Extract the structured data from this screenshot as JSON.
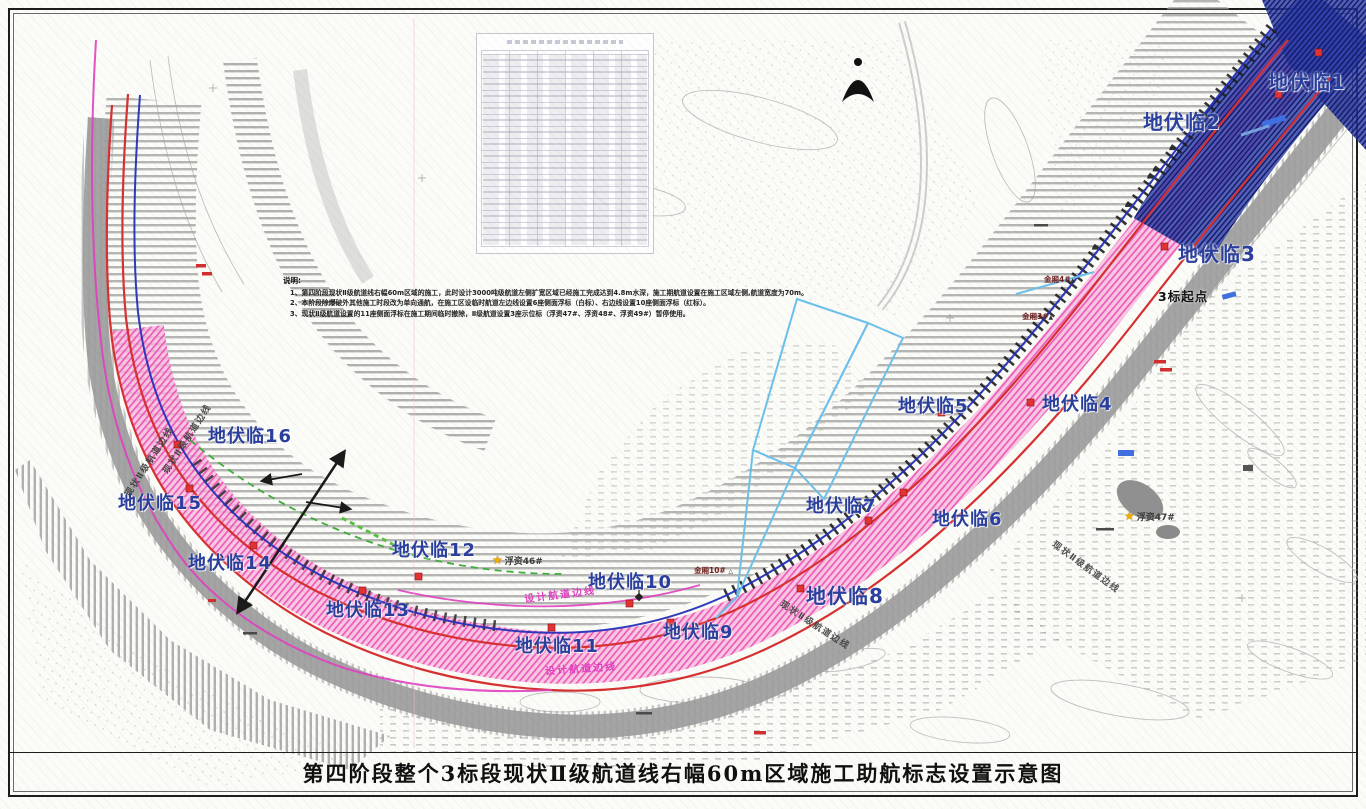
{
  "frame": {
    "title": "第四阶段整个3标段现状Ⅱ级航道线右幅60m区域施工助航标志设置示意图"
  },
  "notes": {
    "heading": "说明:",
    "items": [
      "1、第四阶段现状Ⅱ级航道线右幅60m区域的施工，此时设计3000吨级航道左侧扩宽区域已经施工完成达到4.8m水深，施工期航道设置在施工区域左侧,航道宽度为70m。",
      "2、本阶段除爆破外其他施工时段改为单向通航，在施工区设临时航道左边线设置6座侧面浮标（白标）、右边线设置10座侧面浮标（红标）。",
      "3、现状Ⅱ级航道设置的11座侧面浮标在施工期间临时撤除，Ⅱ级航道设置3座示位标（浮资47#、浮资48#、浮资49#）暂停使用。"
    ]
  },
  "temp_markers": {
    "labels": [
      "地伏临1",
      "地伏临2",
      "地伏临3",
      "地伏临4",
      "地伏临5",
      "地伏临6",
      "地伏临7",
      "地伏临8",
      "地伏临9",
      "地伏临10",
      "地伏临11",
      "地伏临12",
      "地伏临13",
      "地伏临14",
      "地伏临15",
      "地伏临16"
    ]
  },
  "stations": {
    "jinxiang_4": "金厢4#",
    "jinxiang_3": "金厢3#",
    "jinxiang_10": "金厢10#",
    "section_start": "3标起点"
  },
  "buoys": {
    "fz46": "浮资46#",
    "fz47": "浮资47#"
  },
  "line_labels": {
    "existing": "现状Ⅱ级航道边线",
    "design": "设计航道边线"
  },
  "symbols": {
    "buoy_star": "★",
    "station_triangle": "▲",
    "small_triangle": "△"
  },
  "colors": {
    "marker_label": "#2a3f9d",
    "channel_line_red": "#d63030",
    "navigation_line_blue": "#2430b8",
    "design_line_magenta": "#e040c0",
    "temp_line_green": "#3fae3e",
    "construction_zone_pink": "#f06ec0",
    "completed_zone_blue": "#232f8f",
    "structure_cyan": "#6cc0ea"
  }
}
